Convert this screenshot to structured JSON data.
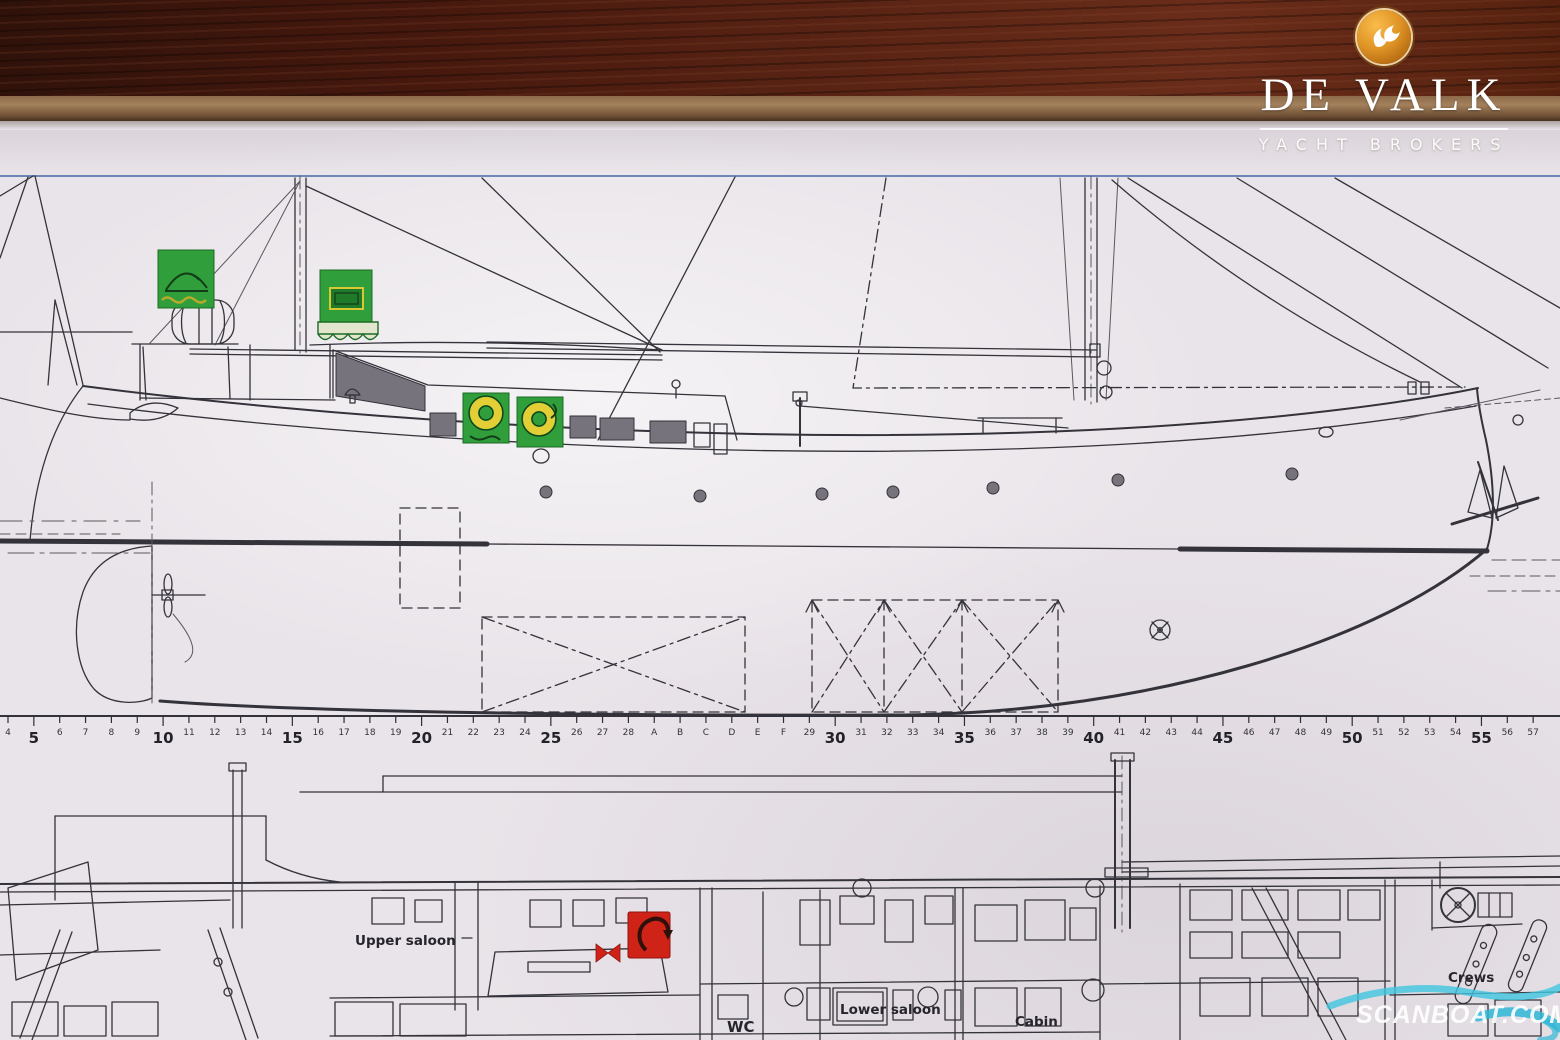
{
  "branding": {
    "name": "DE VALK",
    "tagline": "YACHT BROKERS",
    "badge_icon": "falcon-icon",
    "badge_color": "#e09526",
    "text_color": "#ffffff"
  },
  "watermark": {
    "text": "SCANBOAT.COM",
    "wave_color": "#3ec6e0",
    "text_color": "#ffffff"
  },
  "plan_labels": {
    "upper_saloon": "Upper saloon",
    "wc": "WC",
    "lower_saloon": "Lower saloon",
    "cabin": "Cabin",
    "crews": "Crews"
  },
  "ruler": {
    "baseline_y": 716,
    "start_x": 8,
    "spacing": 25.85,
    "labels": [
      "4",
      "5",
      "6",
      "7",
      "8",
      "9",
      "10",
      "11",
      "12",
      "13",
      "14",
      "15",
      "16",
      "17",
      "18",
      "19",
      "20",
      "21",
      "22",
      "23",
      "24",
      "25",
      "26",
      "27",
      "28",
      "A",
      "B",
      "C",
      "D",
      "E",
      "F",
      "29",
      "30",
      "31",
      "32",
      "33",
      "34",
      "35",
      "36",
      "37",
      "38",
      "39",
      "40",
      "41",
      "42",
      "43",
      "44",
      "45",
      "46",
      "47",
      "48",
      "49",
      "50",
      "51",
      "52",
      "53",
      "54",
      "55",
      "56",
      "57"
    ],
    "major_labels": [
      "5",
      "10",
      "15",
      "20",
      "25",
      "30",
      "35",
      "40",
      "45",
      "50",
      "55"
    ]
  },
  "stickers": {
    "liferaft": "liferaft-sticker",
    "hatch": "hatch-sticker",
    "lifebuoy_1": "lifebuoy-sticker",
    "lifebuoy_2": "lifebuoy-sticker",
    "fire_hook": "fire-equipment-sticker",
    "green": "#2f9e3b",
    "yellow": "#e3cf35",
    "red": "#cf2318"
  },
  "colors": {
    "paper": "#e9e4e9",
    "ink": "#34323a",
    "blue_guideline": "#5577b0",
    "wood": "#47190e",
    "table_edge": "#a3815c"
  }
}
